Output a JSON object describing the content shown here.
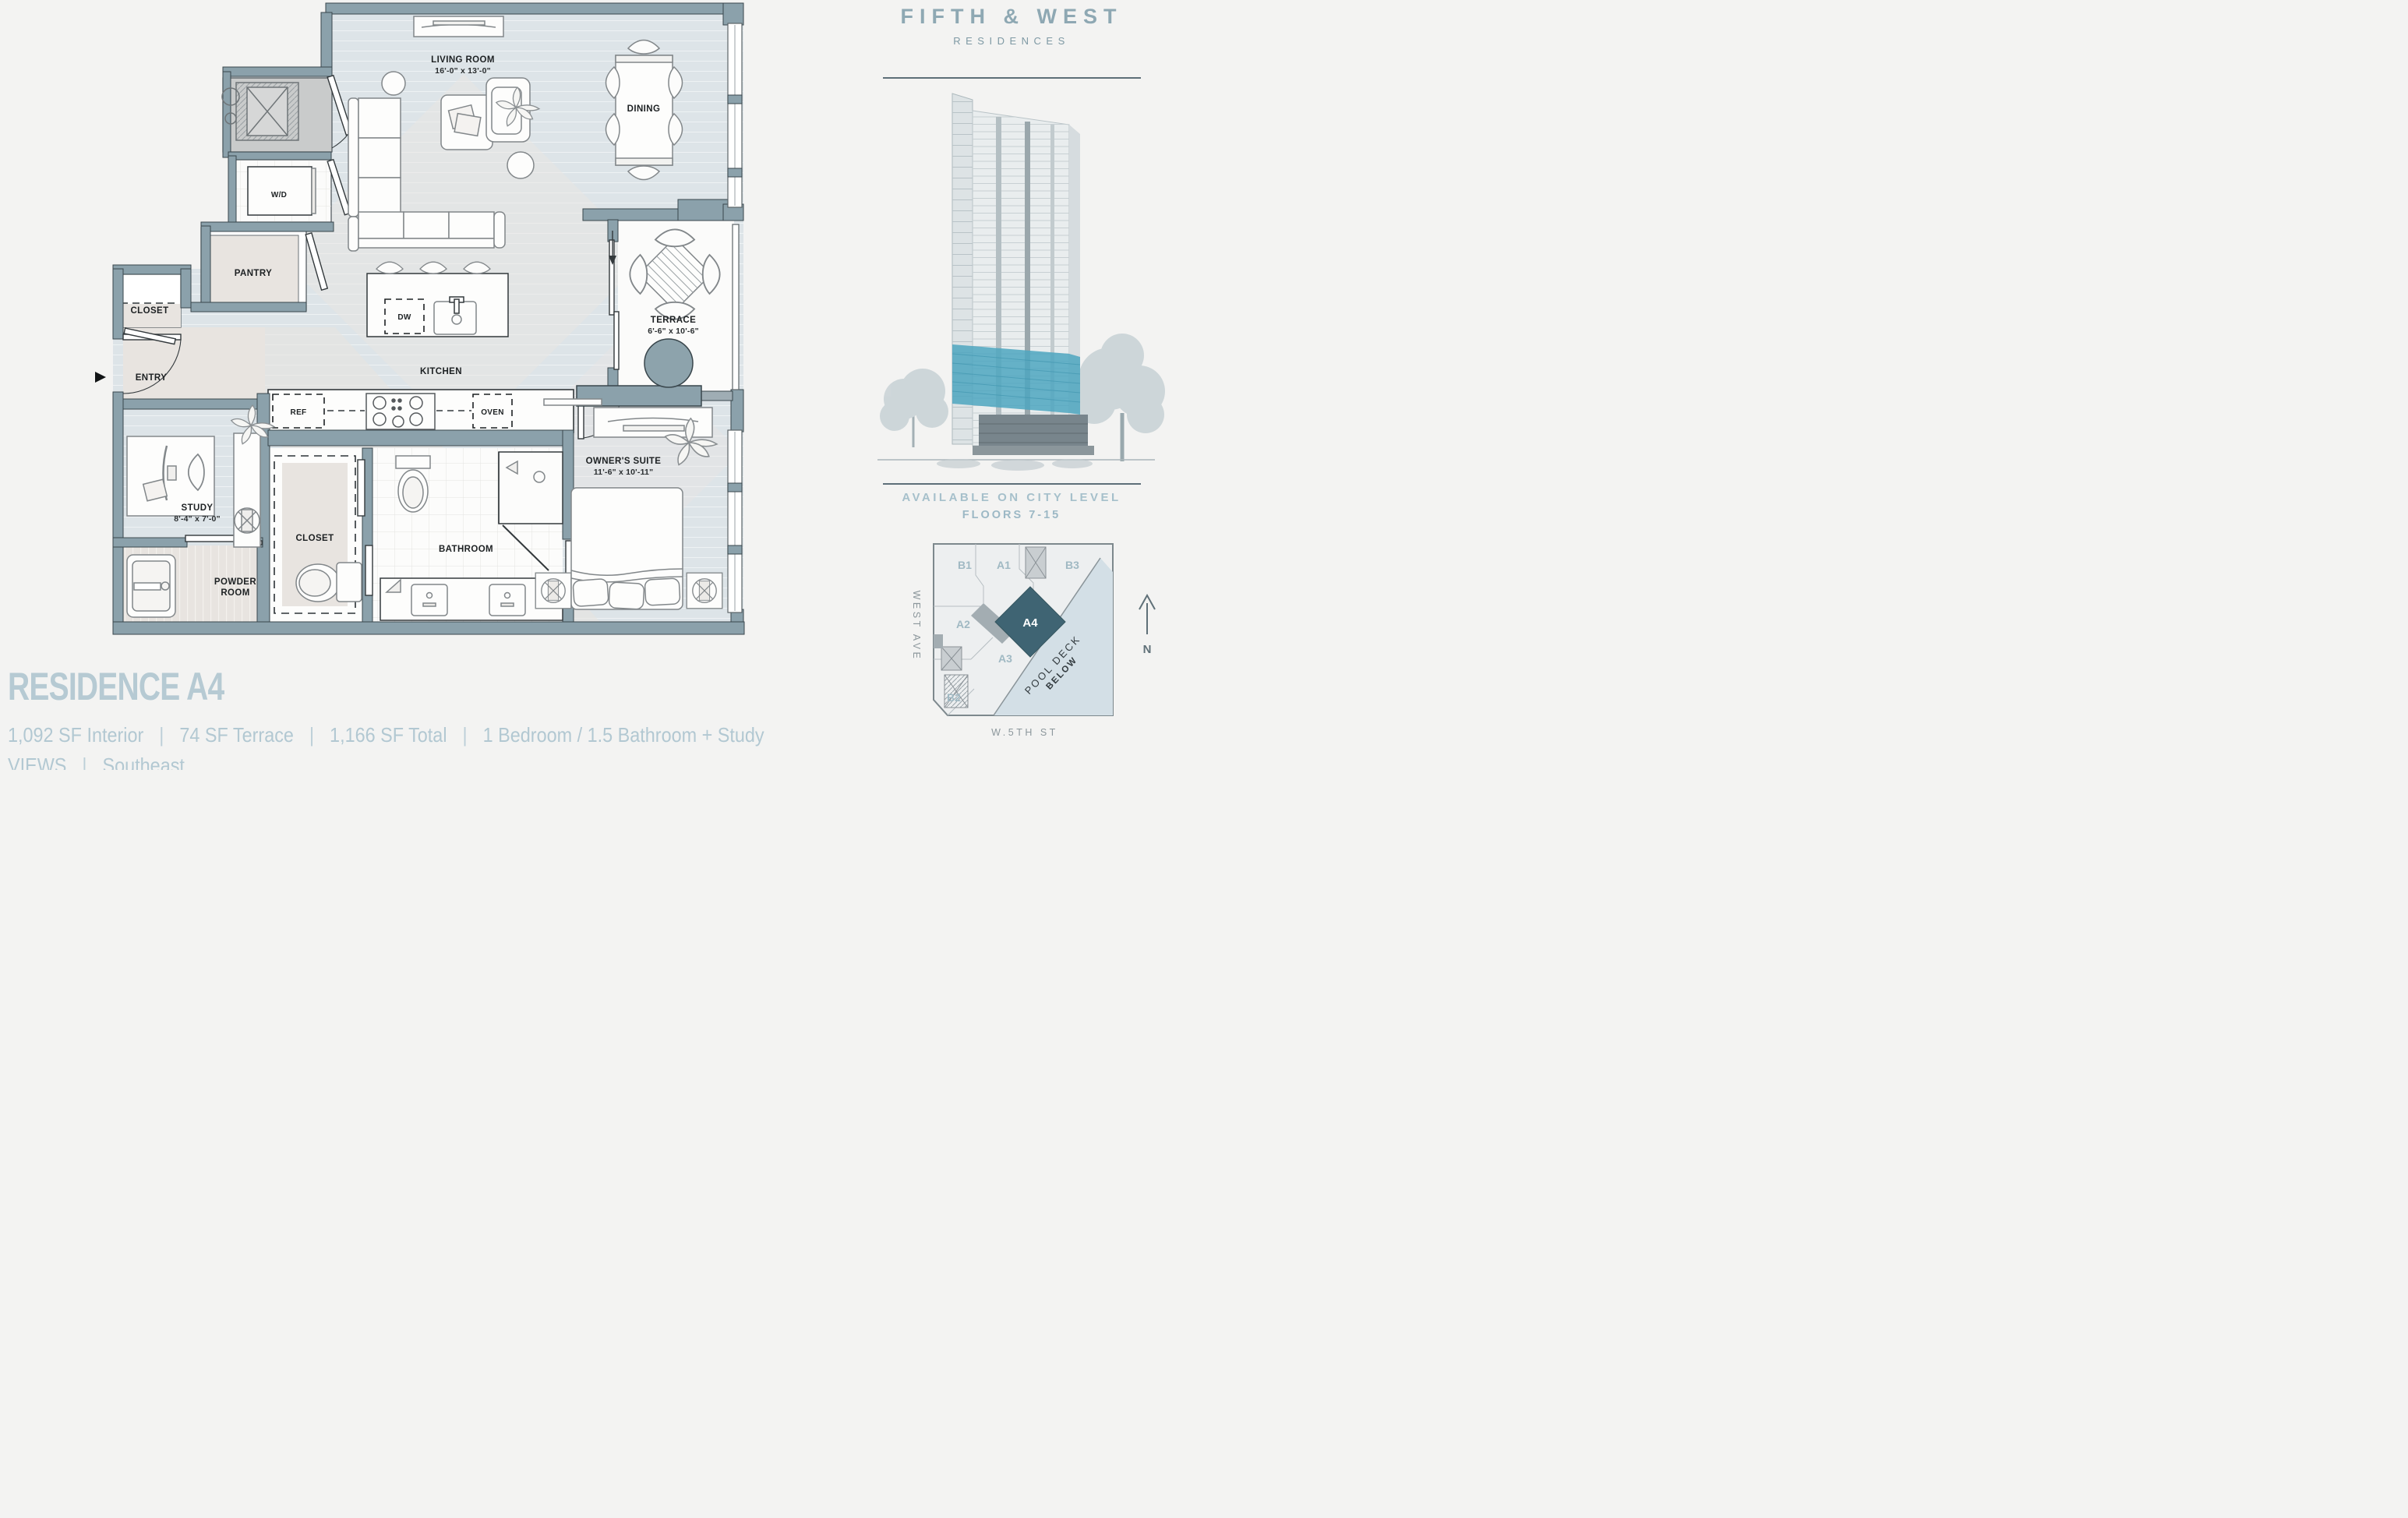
{
  "brand": {
    "name": "FIFTH & WEST",
    "sub": "RESIDENCES"
  },
  "availability": {
    "line1": "AVAILABLE ON CITY LEVEL",
    "line2": "FLOORS 7-15"
  },
  "floorplan": {
    "rooms": {
      "living": {
        "label": "LIVING ROOM",
        "dims": "16'-0\" x 13'-0\""
      },
      "dining": {
        "label": "DINING"
      },
      "kitchen": {
        "label": "KITCHEN"
      },
      "terrace": {
        "label": "TERRACE",
        "dims": "6'-6\" x 10'-6\""
      },
      "owners_suite": {
        "label": "OWNER'S SUITE",
        "dims": "11'-6\" x 10'-11\""
      },
      "study": {
        "label": "STUDY",
        "dims": "8'-4\" x 7'-0\""
      },
      "bathroom": {
        "label": "BATHROOM"
      },
      "powder_line1": "POWDER",
      "powder_line2": "ROOM",
      "closet_entry": "CLOSET",
      "closet_owner": "CLOSET",
      "pantry": "PANTRY",
      "entry": "ENTRY"
    },
    "fixtures": {
      "wd": "W/D",
      "dw": "DW",
      "ref": "REF",
      "oven": "OVEN"
    }
  },
  "siteplan": {
    "units": {
      "b1": "B1",
      "a1": "A1",
      "b3": "B3",
      "a2": "A2",
      "a4": "A4",
      "a3": "A3",
      "b2": "B2"
    },
    "pool_line1": "POOL DECK",
    "pool_line2": "BELOW",
    "street_west": "WEST AVE",
    "street_south": "W.5TH ST",
    "north": "N"
  },
  "info": {
    "title": "RESIDENCE A4",
    "stats": [
      "1,092 SF Interior",
      "74 SF Terrace",
      "1,166 SF Total",
      "1 Bedroom / 1.5 Bathroom + Study"
    ],
    "views_label": "VIEWS",
    "views_value": "Southeast",
    "separator": "|"
  },
  "colors": {
    "wall": "#8ba1ab",
    "floor": "#dde4e8",
    "accent_teal": "#4ea6bf",
    "unit_highlight": "#3f6473",
    "brand_text": "#8ea8b3",
    "light_text": "#b2c8d2"
  }
}
